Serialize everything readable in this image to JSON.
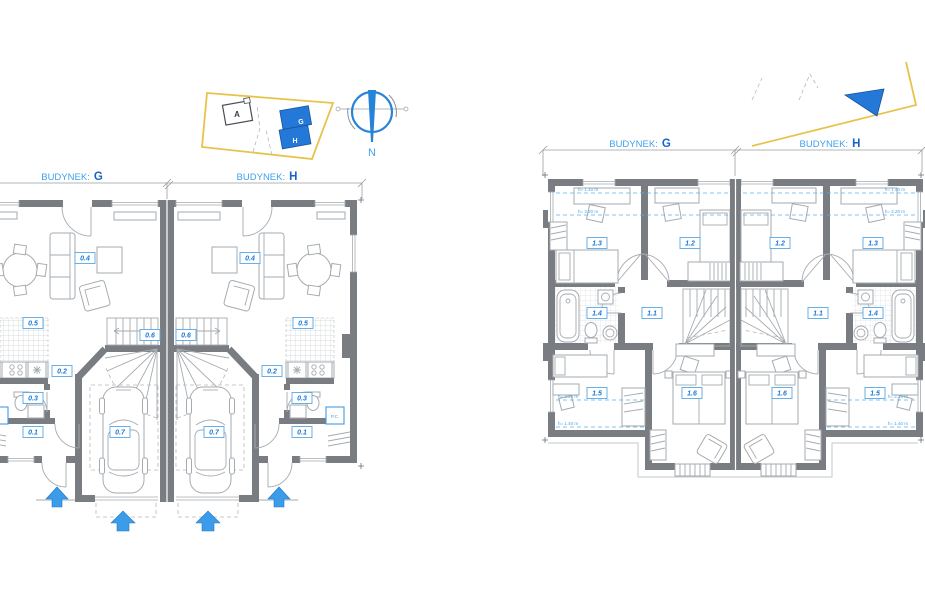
{
  "labels": {
    "budynek_prefix": "BUDYNEK:",
    "g": "G",
    "h": "H"
  },
  "site": {
    "building_a": "A",
    "building_g": "G",
    "building_h": "H",
    "north": "N"
  },
  "gf": {
    "r01": "0.1",
    "r02": "0.2",
    "r03": "0.3",
    "r04": "0.4",
    "r05": "0.5",
    "r06": "0.6",
    "r07": "0.7",
    "pc": "P.C."
  },
  "uf": {
    "r11": "1.1",
    "r12": "1.2",
    "r13": "1.3",
    "r14": "1.4",
    "r15": "1.5",
    "r16": "1.6",
    "h140": "h= 1.40 m",
    "h220": "h= 2.20 m"
  },
  "colors": {
    "accent_blue": "#2b8fe8",
    "label_blue": "#1b78d4",
    "wall_gray": "#797d81",
    "boundary_yellow": "#e7c34c",
    "building_blue": "#2478d8"
  }
}
